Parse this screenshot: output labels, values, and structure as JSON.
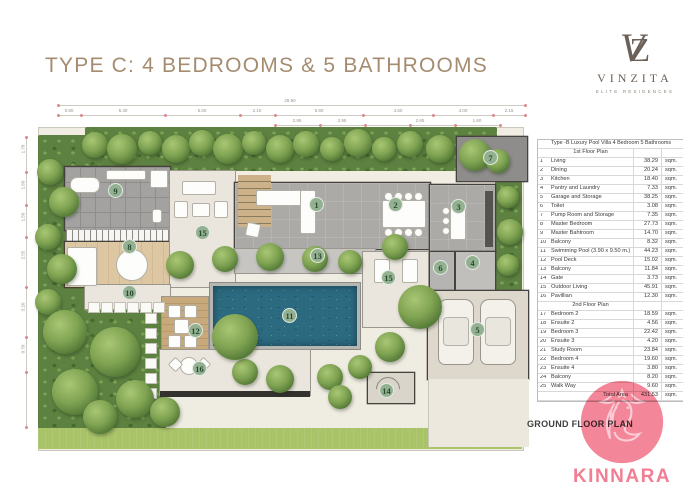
{
  "header": {
    "title": "TYPE C: 4 BEDROOMS & 5 BATHROOMS"
  },
  "logo": {
    "mono_v": "V",
    "mono_z": "Z",
    "brand": "VINZITA",
    "tagline": "ELITE RESIDENCES"
  },
  "plan": {
    "ground_label": "GROUND FLOOR PLAN",
    "dim_total": "28.90",
    "dims_top": [
      "0.80",
      "5.40",
      "5.00",
      "2.10",
      "5.90",
      "4.50",
      "4.00",
      "2.15"
    ],
    "dims_top2": [
      "2.95",
      "2.95",
      "2.65",
      "1.60"
    ],
    "dims_left": [
      "1.78",
      "1.60",
      "1.50",
      "2.55",
      "3.20",
      "0.70"
    ],
    "badges": [
      "1",
      "2",
      "3",
      "4",
      "5",
      "6",
      "7",
      "8",
      "9",
      "10",
      "11",
      "12",
      "13",
      "14",
      "15",
      "16",
      "15"
    ]
  },
  "table": {
    "title": "Type -B  Luxury Pool Villa    4 Bedroom  5 Bathrooms",
    "unit": "sqm.",
    "sections": [
      {
        "heading": "1st Floor Plan",
        "rows": [
          [
            "1",
            "Living",
            "38.29"
          ],
          [
            "2",
            "Dining",
            "20.24"
          ],
          [
            "3",
            "Kitchen",
            "18.40"
          ],
          [
            "4",
            "Pantry and Laundry",
            "7.33"
          ],
          [
            "5",
            "Garage and Storage",
            "38.25"
          ],
          [
            "6",
            "Toilet",
            "3.08"
          ],
          [
            "7",
            "Pump Room and Storage",
            "7.35"
          ],
          [
            "8",
            "Master Bedroom",
            "27.73"
          ],
          [
            "9",
            "Master Bahtroom",
            "14.70"
          ],
          [
            "10",
            "Balcony",
            "8.32"
          ],
          [
            "11",
            "Swimming Pool (3.90 x 9.50 m.)",
            "44.23"
          ],
          [
            "12",
            "Pool Deck",
            "15.02"
          ],
          [
            "13",
            "Balcony",
            "11.84"
          ],
          [
            "14",
            "Gate",
            "3.73"
          ],
          [
            "15",
            "Outdoor Living",
            "45.91"
          ],
          [
            "16",
            "Pavillian",
            "12.30"
          ]
        ]
      },
      {
        "heading": "2nd Floor Plan",
        "rows": [
          [
            "17",
            "Bedroom 2",
            "18.59"
          ],
          [
            "18",
            "Ensuite 2",
            "4.56"
          ],
          [
            "19",
            "Bedroom 3",
            "22.42"
          ],
          [
            "20",
            "Ensuite 3",
            "4.20"
          ],
          [
            "21",
            "Study Room",
            "23.84"
          ],
          [
            "22",
            "Bedroom 4",
            "19.60"
          ],
          [
            "23",
            "Ensuite 4",
            "3.80"
          ],
          [
            "24",
            "Balcony",
            "8.20"
          ],
          [
            "25",
            "Walk Way",
            "9.60"
          ]
        ]
      }
    ],
    "total_label": "Total Area",
    "total_value": "431.53"
  },
  "watermark": {
    "text": "KINNARA"
  }
}
